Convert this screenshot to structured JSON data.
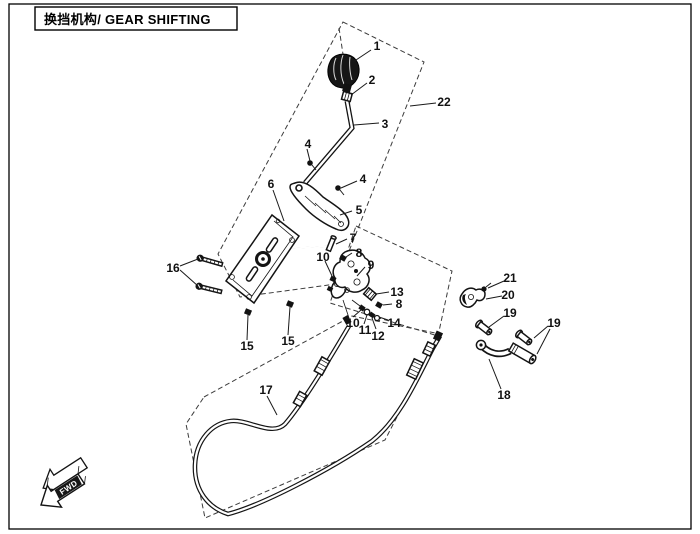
{
  "title": "换挡机构/ GEAR SHIFTING",
  "fwd_marker": "FWD",
  "callouts": [
    {
      "label": "1"
    },
    {
      "label": "2"
    },
    {
      "label": "3"
    },
    {
      "label": "22"
    },
    {
      "label": "4"
    },
    {
      "label": "4"
    },
    {
      "label": "5"
    },
    {
      "label": "6"
    },
    {
      "label": "7"
    },
    {
      "label": "8"
    },
    {
      "label": "9"
    },
    {
      "label": "13"
    },
    {
      "label": "8"
    },
    {
      "label": "14"
    },
    {
      "label": "12"
    },
    {
      "label": "11"
    },
    {
      "label": "10"
    },
    {
      "label": "10"
    },
    {
      "label": "15"
    },
    {
      "label": "15"
    },
    {
      "label": "16"
    },
    {
      "label": "17"
    },
    {
      "label": "18"
    },
    {
      "label": "19"
    },
    {
      "label": "19"
    },
    {
      "label": "20"
    },
    {
      "label": "21"
    }
  ]
}
